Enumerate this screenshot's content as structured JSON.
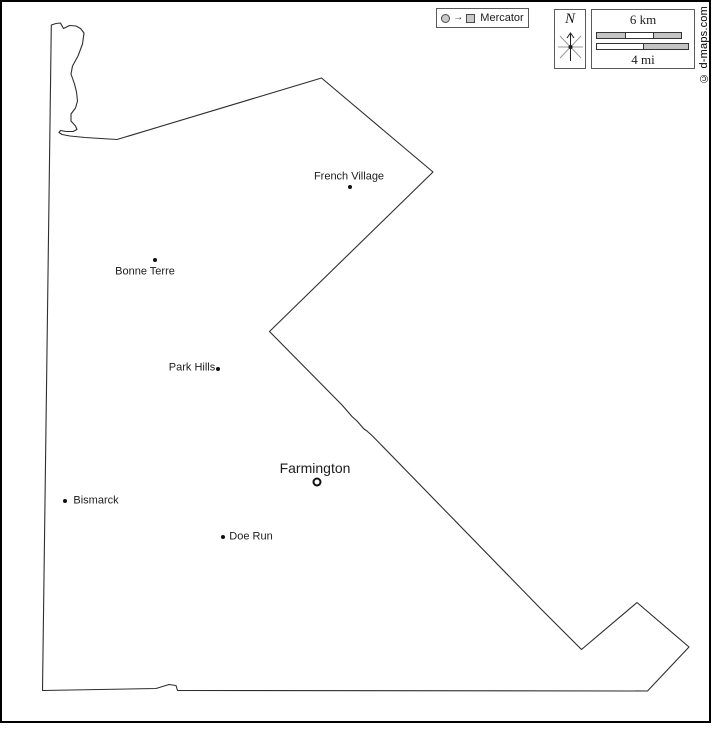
{
  "legend": {
    "projection_label": "Mercator"
  },
  "compass": {
    "north_label": "N"
  },
  "scale_bar": {
    "top_label": "6 km",
    "bottom_label": "4 mi"
  },
  "copyright": "© d-maps.com",
  "colors": {
    "outline": "#2e2e2e",
    "frame": "#000000",
    "glyph_fill": "#c9c9c9",
    "text": "#1c1c1c",
    "background": "#ffffff"
  },
  "cities": [
    {
      "name": "French Village",
      "type": "town",
      "marker": {
        "x": 350,
        "y": 187
      },
      "label": {
        "x": 349,
        "y": 177
      }
    },
    {
      "name": "Bonne Terre",
      "type": "town",
      "marker": {
        "x": 155,
        "y": 260
      },
      "label": {
        "x": 145,
        "y": 272
      }
    },
    {
      "name": "Park Hills",
      "type": "town",
      "marker": {
        "x": 218,
        "y": 369
      },
      "label": {
        "x": 192,
        "y": 368
      }
    },
    {
      "name": "Farmington",
      "type": "county-seat",
      "marker": {
        "x": 317,
        "y": 482
      },
      "label": {
        "x": 315,
        "y": 468
      }
    },
    {
      "name": "Bismarck",
      "type": "town",
      "marker": {
        "x": 65,
        "y": 501
      },
      "label": {
        "x": 96,
        "y": 501
      }
    },
    {
      "name": "Doe Run",
      "type": "town",
      "marker": {
        "x": 223,
        "y": 537
      },
      "label": {
        "x": 251,
        "y": 537
      }
    }
  ]
}
